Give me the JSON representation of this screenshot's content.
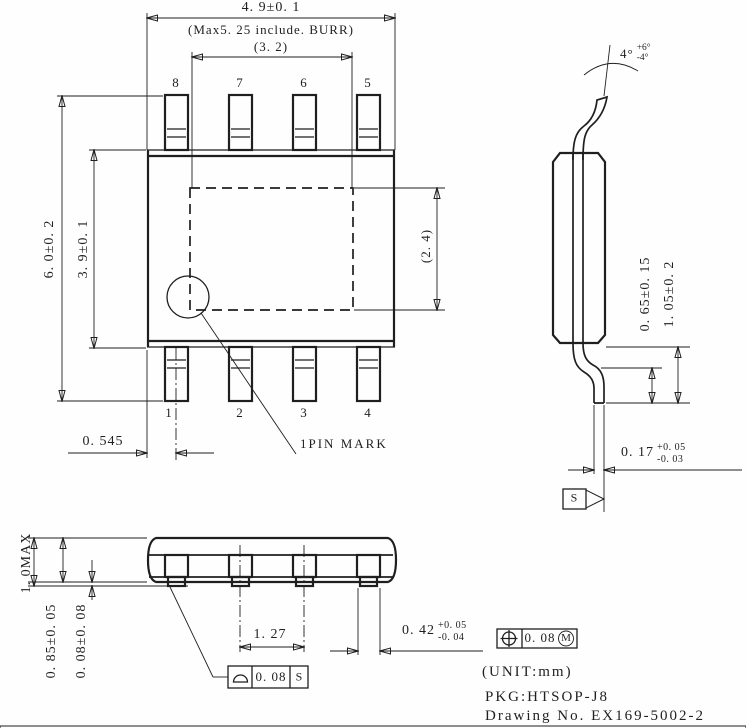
{
  "drawing": {
    "ink_color": "#1f1f1f",
    "background_color": "#ffffff",
    "title_block": {
      "unit_note": "(UNIT:mm)",
      "package_name": "PKG:HTSOP-J8",
      "drawing_number": "Drawing No. EX169-5002-2"
    },
    "top_view": {
      "dim_body_width": "4. 9±0. 1",
      "dim_max_with_burr": "(Max5. 25 include. BURR)",
      "dim_pad_width": "(3. 2)",
      "dim_overall_height": "6. 0±0. 2",
      "dim_body_height": "3. 9±0. 1",
      "dim_pad_height": "(2. 4)",
      "dim_pin1_offset": "0. 545",
      "pin_mark_label": "1PIN MARK",
      "pin_numbers_top": [
        "8",
        "7",
        "6",
        "5"
      ],
      "pin_numbers_bottom": [
        "1",
        "2",
        "3",
        "4"
      ]
    },
    "side_view": {
      "lead_angle": "4°",
      "lead_angle_plus": "+6°",
      "lead_angle_minus": "-4°",
      "dim_foot_length": "0. 65±0. 15",
      "dim_lead_height": "1. 05±0. 2",
      "dim_lead_thickness": "0. 17",
      "dim_lead_thickness_plus": "+0. 05",
      "dim_lead_thickness_minus": "-0. 03",
      "datum_label": "S"
    },
    "front_view": {
      "dim_overall_height": "1. 0MAX",
      "dim_body_thickness": "0. 85±0. 05",
      "dim_standoff": "0. 08±0. 08",
      "dim_lead_pitch": "1. 27",
      "dim_lead_width": "0. 42",
      "dim_lead_width_plus": "+0. 05",
      "dim_lead_width_minus": "-0. 04",
      "position_tolerance_value": "0. 08",
      "position_tolerance_modifier": "M",
      "seating_tolerance_value": "0. 08",
      "seating_tolerance_datum": "S"
    }
  }
}
